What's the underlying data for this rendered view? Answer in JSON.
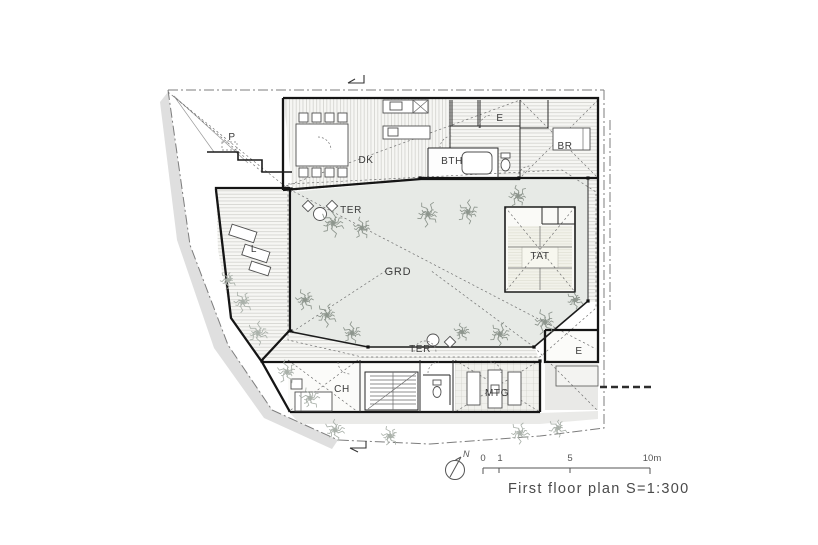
{
  "drawing": {
    "caption": "First floor plan  S=1:300",
    "north_label": "N",
    "scale_labels": [
      "0",
      "1",
      "5",
      "10m"
    ],
    "rooms": [
      {
        "code": "P",
        "name": "parking"
      },
      {
        "code": "DK",
        "name": "dining-kitchen"
      },
      {
        "code": "E",
        "name": "entrance-upper"
      },
      {
        "code": "BTH",
        "name": "bathroom"
      },
      {
        "code": "BR",
        "name": "bedroom"
      },
      {
        "code": "TER",
        "name": "terrace-upper"
      },
      {
        "code": "L",
        "name": "living-room"
      },
      {
        "code": "GRD",
        "name": "garden-courtyard"
      },
      {
        "code": "TAT",
        "name": "tatami-room"
      },
      {
        "code": "TER",
        "name": "terrace-lower"
      },
      {
        "code": "CH",
        "name": "children-room"
      },
      {
        "code": "MTG",
        "name": "meeting-room"
      },
      {
        "code": "E",
        "name": "entrance-lower"
      }
    ],
    "colors": {
      "wall_line": "#151515",
      "boundary_line": "#7d7d7d",
      "courtyard_fill": "#e7eae6",
      "exterior_fill": "#dfdfdf",
      "tree_inner": "#8d958d",
      "tree_outer": "#aab1aa",
      "caption_text": "#4a4a4a"
    }
  }
}
